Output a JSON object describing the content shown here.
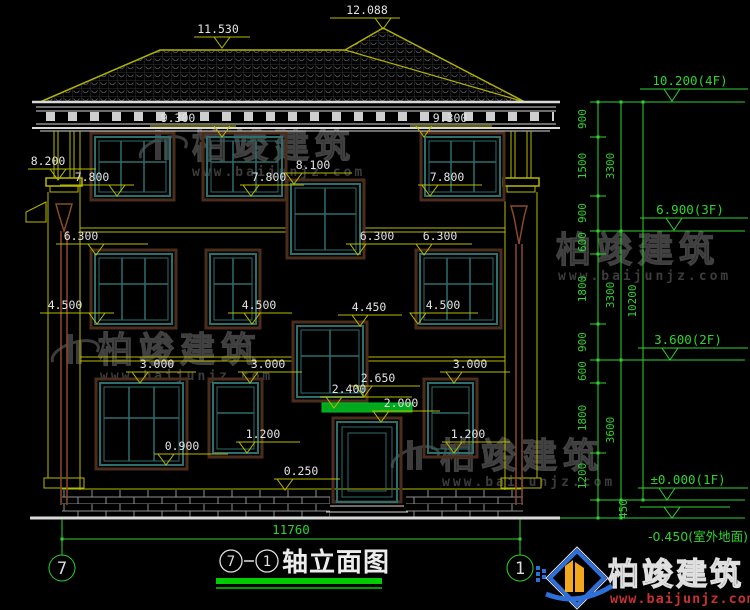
{
  "drawing_title": {
    "axis_start": "7",
    "axis_end": "1",
    "name": "轴立面图"
  },
  "axis_bubbles": {
    "left": "7",
    "right": "1"
  },
  "marks": [
    {
      "name": "ridge-high",
      "label": "12.088"
    },
    {
      "name": "ridge-low",
      "label": "11.530"
    },
    {
      "name": "cornice-left",
      "label": "9.300"
    },
    {
      "name": "cornice-right",
      "label": "9.300"
    },
    {
      "name": "pilaster-capital",
      "label": "8.200"
    },
    {
      "name": "sill-3f-left",
      "label": "7.800"
    },
    {
      "name": "stair-window-head",
      "label": "8.100"
    },
    {
      "name": "sill-3f-mid",
      "label": "7.800"
    },
    {
      "name": "sill-3f-right",
      "label": "7.800"
    },
    {
      "name": "head-2f-left",
      "label": "6.300"
    },
    {
      "name": "stair-window-sill",
      "label": "6.300"
    },
    {
      "name": "head-2f-right",
      "label": "6.300"
    },
    {
      "name": "sill-2f-left",
      "label": "4.500"
    },
    {
      "name": "stair2-head",
      "label": "4.450"
    },
    {
      "name": "sill-2f-mid",
      "label": "4.500"
    },
    {
      "name": "sill-2f-right",
      "label": "4.500"
    },
    {
      "name": "head-1f-left",
      "label": "3.000"
    },
    {
      "name": "head-1f-mid",
      "label": "3.000"
    },
    {
      "name": "head-1f-right",
      "label": "3.000"
    },
    {
      "name": "canopy-trim",
      "label": "2.650"
    },
    {
      "name": "canopy-top",
      "label": "2.400"
    },
    {
      "name": "door-head",
      "label": "2.000"
    },
    {
      "name": "sill-1f-mid",
      "label": "1.200"
    },
    {
      "name": "sill-1f-left",
      "label": "0.900"
    },
    {
      "name": "sill-1f-right",
      "label": "1.200"
    },
    {
      "name": "plinth-top",
      "label": "0.250"
    }
  ],
  "floor_levels": [
    {
      "label": "10.200(4F)"
    },
    {
      "label": "6.900(3F)"
    },
    {
      "label": "3.600(2F)"
    },
    {
      "label": "±0.000(1F)"
    },
    {
      "label": "-0.450(室外地面)"
    }
  ],
  "vdims": {
    "inner": [
      "900",
      "1500",
      "900",
      "600",
      "1800",
      "900",
      "600",
      "1800",
      "1200"
    ],
    "middle": [
      "3300",
      "3300",
      "3600"
    ],
    "total": "10200",
    "ground_offset": "450"
  },
  "hdims": {
    "total_width": "11760"
  },
  "watermark": {
    "brand": "柏竣建筑",
    "site": "www.baijunjz.com"
  },
  "logo": {
    "brand": "柏竣建筑",
    "site": "www.baijunjz.com"
  },
  "colors": {
    "background": "#000000",
    "wall": "#b9b900",
    "white_line": "#d9d9d9",
    "window": "#2e6e6e",
    "surround": "#4a2d1c",
    "dimension": "#2fd32f",
    "canopy": "#00a81e",
    "downspout": "#8a4a2a",
    "watermark": "#3a3a3a",
    "logo_blue": "#2f6fd8",
    "logo_yellow": "#f2a81c",
    "logo_red": "#c63030"
  }
}
